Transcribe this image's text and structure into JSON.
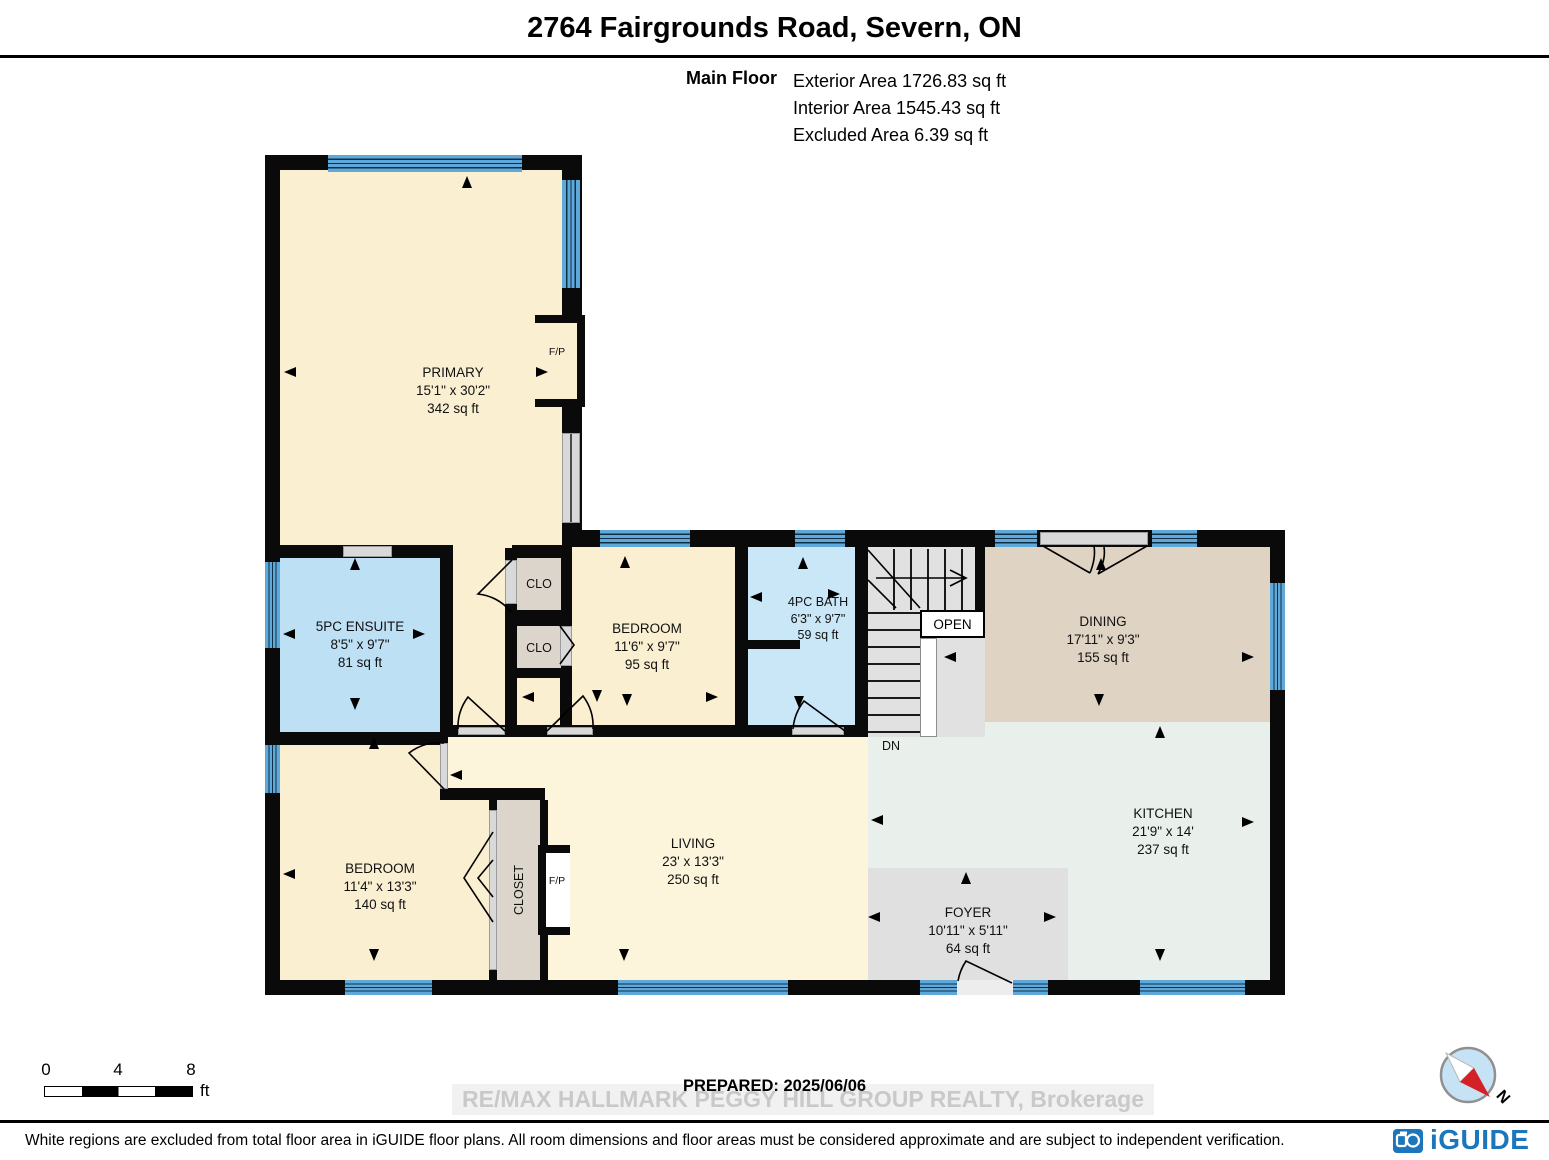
{
  "header": {
    "title": "2764 Fairgrounds Road, Severn, ON",
    "floor_label": "Main Floor",
    "stats": [
      "Exterior Area 1726.83 sq ft",
      "Interior Area 1545.43 sq ft",
      "Excluded Area 6.39 sq ft"
    ]
  },
  "rooms": [
    {
      "name": "PRIMARY",
      "dimensions": "15'1\" x 30'2\"",
      "area": "342 sq ft"
    },
    {
      "name": "5PC ENSUITE",
      "dimensions": "8'5\" x 9'7\"",
      "area": "81 sq ft"
    },
    {
      "name": "BEDROOM",
      "dimensions": "11'6\" x 9'7\"",
      "area": "95 sq ft"
    },
    {
      "name": "4PC BATH",
      "dimensions": "6'3\" x 9'7\"",
      "area": "59 sq ft"
    },
    {
      "name": "DINING",
      "dimensions": "17'11\" x 9'3\"",
      "area": "155 sq ft"
    },
    {
      "name": "LIVING",
      "dimensions": "23' x 13'3\"",
      "area": "250 sq ft"
    },
    {
      "name": "KITCHEN",
      "dimensions": "21'9\" x 14'",
      "area": "237 sq ft"
    },
    {
      "name": "FOYER",
      "dimensions": "10'11\" x 5'11\"",
      "area": "64 sq ft"
    },
    {
      "name": "BEDROOM",
      "dimensions": "11'4\" x 13'3\"",
      "area": "140 sq ft"
    }
  ],
  "labels": {
    "clo": "CLO",
    "closet": "CLOSET",
    "open": "OPEN",
    "dn": "DN",
    "fp": "F/P"
  },
  "scale": {
    "ticks": [
      "0",
      "4",
      "8"
    ],
    "unit": "ft"
  },
  "footer": {
    "prepared": "PREPARED: 2025/06/06",
    "watermark": "RE/MAX HALLMARK PEGGY HILL GROUP REALTY, Brokerage",
    "disclaimer": "White regions are excluded from total floor area in iGUIDE floor plans. All room dimensions and floor areas must be considered approximate and are subject to independent verification.",
    "brand": "iGUIDE",
    "compass_label": "N"
  },
  "colors": {
    "wall": "#0A0A0A",
    "room_cream": "#FAEFD1",
    "living_cream": "#FCF5DC",
    "ensuite_blue": "#BEE0F4",
    "bath_blue": "#C9E7F7",
    "dining_tan": "#DFD3C4",
    "kitchen_green": "#E9F0EB",
    "gray_floor": "#E0E0E0",
    "closet_fill": "#DCD5CB",
    "window_blue": "#5FA9DA",
    "brand_blue": "#1C76BC",
    "compass_red": "#D42127"
  }
}
